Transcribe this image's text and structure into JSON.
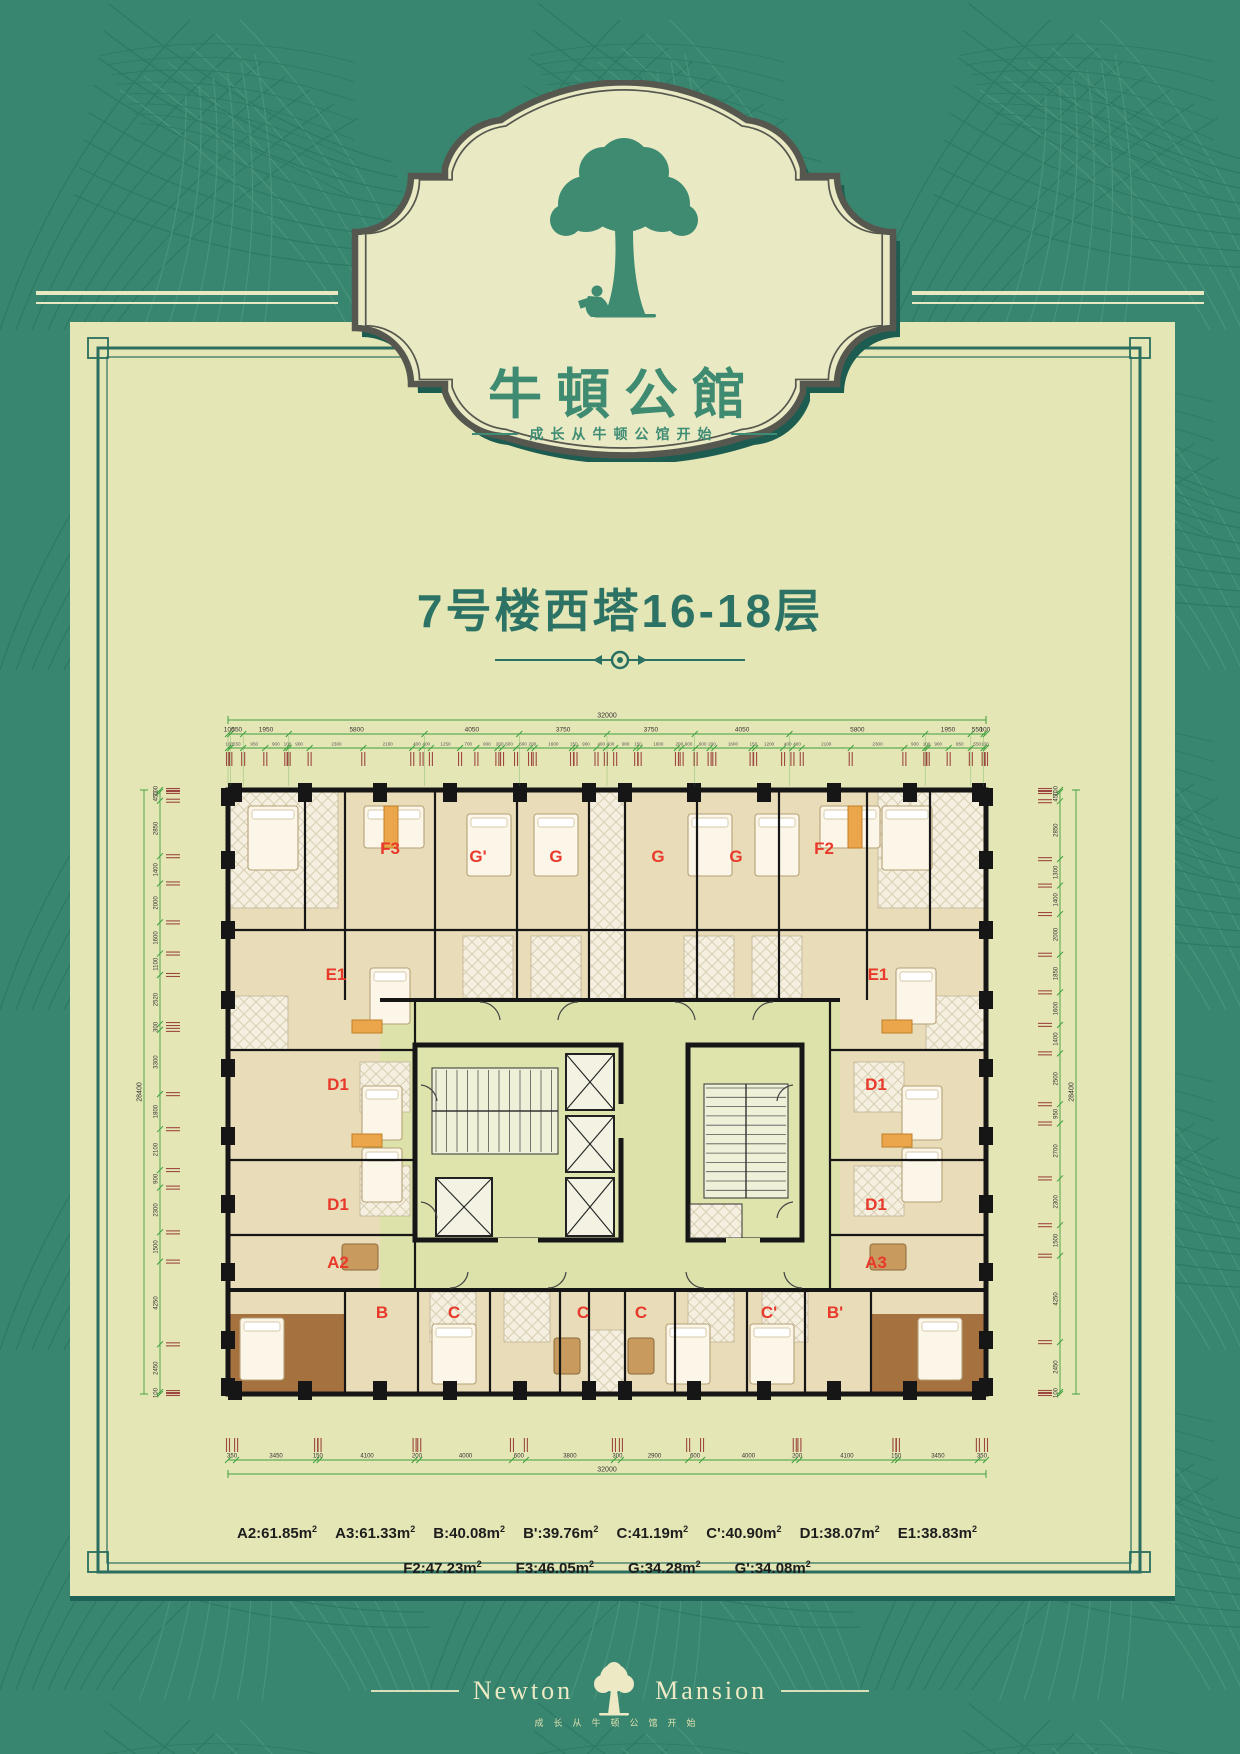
{
  "badge": {
    "brand": "牛頓公館",
    "tagline": "成长从牛顿公馆开始"
  },
  "title": {
    "text": "7号楼西塔16-18层"
  },
  "colors": {
    "bg_green": "#38866f",
    "panel_cream": "#e5e6b5",
    "border_teal": "#2a6e60",
    "badge_border": "#56574e",
    "badge_shadow": "#1d5c50",
    "brand_green": "#3e8b72",
    "title_green": "#2d7365",
    "unit_label_red": "#e8392b",
    "dim_green": "#3ea03e",
    "dim_tick_red": "#9c4840",
    "wall_black": "#161616",
    "courtyard_green": "#dce2a9"
  },
  "floor_plan": {
    "unit_labels": [
      {
        "t": "F3",
        "x": 260,
        "y": 164
      },
      {
        "t": "G'",
        "x": 348,
        "y": 172
      },
      {
        "t": "G",
        "x": 426,
        "y": 172
      },
      {
        "t": "G",
        "x": 528,
        "y": 172
      },
      {
        "t": "G",
        "x": 606,
        "y": 172
      },
      {
        "t": "F2",
        "x": 694,
        "y": 164
      },
      {
        "t": "E1",
        "x": 206,
        "y": 290
      },
      {
        "t": "E1",
        "x": 748,
        "y": 290
      },
      {
        "t": "D1",
        "x": 208,
        "y": 400
      },
      {
        "t": "D1",
        "x": 746,
        "y": 400
      },
      {
        "t": "D1",
        "x": 208,
        "y": 520
      },
      {
        "t": "D1",
        "x": 746,
        "y": 520
      },
      {
        "t": "A2",
        "x": 208,
        "y": 578
      },
      {
        "t": "A3",
        "x": 746,
        "y": 578
      },
      {
        "t": "B",
        "x": 252,
        "y": 628
      },
      {
        "t": "C",
        "x": 324,
        "y": 628
      },
      {
        "t": "C",
        "x": 453,
        "y": 628
      },
      {
        "t": "C",
        "x": 511,
        "y": 628
      },
      {
        "t": "C'",
        "x": 639,
        "y": 628
      },
      {
        "t": "B'",
        "x": 705,
        "y": 628
      }
    ],
    "dims": {
      "top_total": "32000",
      "top_major": [
        "100",
        "550",
        "1950",
        "5800",
        "4050",
        "3750",
        "3750",
        "4050",
        "5800",
        "1950",
        "550",
        "100"
      ],
      "top_minor": [
        "100",
        "550",
        "950",
        "900",
        "100",
        "900",
        "2300",
        "2100",
        "400",
        "400",
        "1250",
        "700",
        "900",
        "200",
        "600",
        "600",
        "200",
        "1600",
        "150",
        "900",
        "400",
        "400",
        "900",
        "150",
        "1600",
        "200",
        "600",
        "600",
        "200",
        "1600",
        "150",
        "1200",
        "400",
        "400",
        "2100",
        "2300",
        "900",
        "100",
        "900",
        "950",
        "550",
        "100"
      ],
      "bottom_major": [
        "350",
        "3450",
        "150",
        "4100",
        "200",
        "4000",
        "600",
        "3800",
        "300",
        "2900",
        "600",
        "4000",
        "200",
        "4100",
        "150",
        "3450",
        "350"
      ],
      "bottom_total": "32000",
      "left_vals": [
        "100",
        "450",
        "2850",
        "1400",
        "2000",
        "1600",
        "1100",
        "2520",
        "300",
        "3300",
        "1800",
        "2100",
        "900",
        "2300",
        "1500",
        "4250",
        "2450",
        "100"
      ],
      "left_total": "28400",
      "right_vals": [
        "100",
        "450",
        "2850",
        "1300",
        "1400",
        "2000",
        "1850",
        "1600",
        "1400",
        "2500",
        "950",
        "2700",
        "2300",
        "1500",
        "4250",
        "2450",
        "100"
      ],
      "right_total": "28400"
    }
  },
  "legend": {
    "unit_suffix": "m",
    "rows": [
      [
        {
          "label": "A2",
          "area": "61.85"
        },
        {
          "label": "A3",
          "area": "61.33"
        },
        {
          "label": "B",
          "area": "40.08"
        },
        {
          "label": "B'",
          "area": "39.76"
        },
        {
          "label": "C",
          "area": "41.19"
        },
        {
          "label": "C'",
          "area": "40.90"
        },
        {
          "label": "D1",
          "area": "38.07"
        },
        {
          "label": "E1",
          "area": "38.83"
        }
      ],
      [
        {
          "label": "F2",
          "area": "47.23"
        },
        {
          "label": "F3",
          "area": "46.05"
        },
        {
          "label": "G",
          "area": "34.28"
        },
        {
          "label": "G'",
          "area": "34.08"
        }
      ]
    ]
  },
  "footer": {
    "brand_left": "Newton",
    "brand_right": "Mansion",
    "tagline": "成长从牛顿公馆开始"
  }
}
